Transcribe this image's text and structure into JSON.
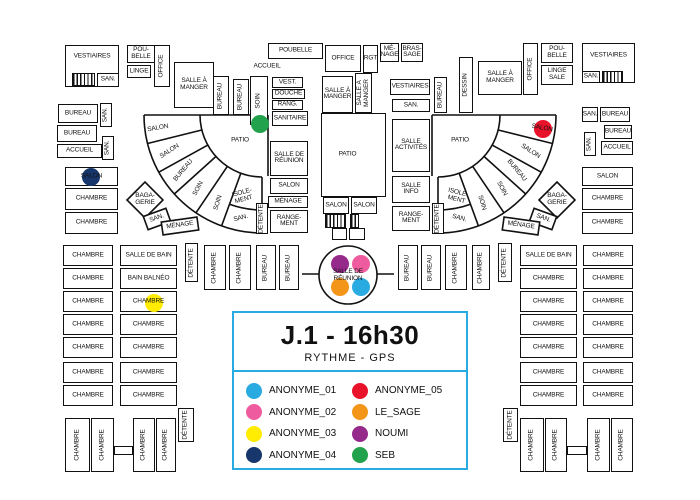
{
  "colors": {
    "wall": "#111111",
    "accent": "#29ABE2",
    "background": "#ffffff"
  },
  "title_card": {
    "title": "J.1 - 16h30",
    "subtitle": "RYTHME - GPS"
  },
  "people": [
    {
      "name": "ANONYME_01",
      "color": "#29ABE2"
    },
    {
      "name": "ANONYME_02",
      "color": "#EE5C9F"
    },
    {
      "name": "ANONYME_03",
      "color": "#FFEC00"
    },
    {
      "name": "ANONYME_04",
      "color": "#17366B"
    },
    {
      "name": "ANONYME_05",
      "color": "#E8132B"
    },
    {
      "name": "LE_SAGE",
      "color": "#F39519"
    },
    {
      "name": "NOUMI",
      "color": "#962A8B"
    },
    {
      "name": "SEB",
      "color": "#23A24D"
    }
  ],
  "markers": [
    {
      "person": "SEB",
      "x": 260,
      "y": 124
    },
    {
      "person": "ANONYME_04",
      "x": 91,
      "y": 177
    },
    {
      "person": "ANONYME_05",
      "x": 543,
      "y": 129
    },
    {
      "person": "ANONYME_03",
      "x": 154,
      "y": 303
    },
    {
      "person": "NOUMI",
      "x": 340,
      "y": 264
    },
    {
      "person": "ANONYME_02",
      "x": 361,
      "y": 264
    },
    {
      "person": "LE_SAGE",
      "x": 340,
      "y": 287
    },
    {
      "person": "ANONYME_01",
      "x": 361,
      "y": 287
    }
  ],
  "floor_plan": {
    "rooms": [
      {
        "t": "VESTIAIRES",
        "x": 65,
        "y": 45,
        "w": 54,
        "h": 42,
        "ly": -9
      },
      {
        "t": "",
        "x": 72,
        "y": 73,
        "w": 23,
        "h": 13,
        "hatch": 1
      },
      {
        "t": "SAN.",
        "x": 97,
        "y": 73,
        "w": 22,
        "h": 14
      },
      {
        "t": "POU-\nBELLE",
        "x": 127,
        "y": 45,
        "w": 28,
        "h": 18
      },
      {
        "t": "LINGE",
        "x": 127,
        "y": 65,
        "w": 24,
        "h": 13
      },
      {
        "t": "OFFICE",
        "x": 154,
        "y": 45,
        "w": 16,
        "h": 42,
        "v": 1
      },
      {
        "t": "SALLE À\nMANGER",
        "x": 174,
        "y": 62,
        "w": 40,
        "h": 46
      },
      {
        "t": "BUREAU",
        "x": 213,
        "y": 76,
        "w": 16,
        "h": 39,
        "v": 1
      },
      {
        "t": "BUREAU",
        "x": 233,
        "y": 79,
        "w": 16,
        "h": 36,
        "v": 1
      },
      {
        "t": "SOIN",
        "x": 250,
        "y": 76,
        "w": 18,
        "h": 49,
        "v": 1
      },
      {
        "t": "BUREAU",
        "x": 58,
        "y": 104,
        "w": 40,
        "h": 19
      },
      {
        "t": "SAN.",
        "x": 100,
        "y": 103,
        "w": 12,
        "h": 24,
        "v": 1
      },
      {
        "t": "BUREAU",
        "x": 57,
        "y": 125,
        "w": 40,
        "h": 17
      },
      {
        "t": "SAN.",
        "x": 102,
        "y": 136,
        "w": 12,
        "h": 24,
        "v": 1
      },
      {
        "t": "ACCUEIL",
        "x": 57,
        "y": 144,
        "w": 45,
        "h": 14
      },
      {
        "t": "SALON",
        "x": 65,
        "y": 167,
        "w": 53,
        "h": 19
      },
      {
        "t": "CHAMBRE",
        "x": 65,
        "y": 188,
        "w": 53,
        "h": 22
      },
      {
        "t": "CHAMBRE",
        "x": 65,
        "y": 212,
        "w": 53,
        "h": 22
      },
      {
        "t": "POUBELLE",
        "x": 268,
        "y": 43,
        "w": 55,
        "h": 16
      },
      {
        "t": "OFFICE",
        "x": 325,
        "y": 45,
        "w": 36,
        "h": 27
      },
      {
        "t": "RGT",
        "x": 363,
        "y": 45,
        "w": 15,
        "h": 28
      },
      {
        "t": "MÉ-\nNAGE",
        "x": 380,
        "y": 43,
        "w": 19,
        "h": 19
      },
      {
        "t": "BRAS-\nSAGE",
        "x": 401,
        "y": 43,
        "w": 22,
        "h": 19
      },
      {
        "t": "VEST.",
        "x": 272,
        "y": 77,
        "w": 31,
        "h": 11
      },
      {
        "t": "DOUCHE",
        "x": 272,
        "y": 89,
        "w": 33,
        "h": 10
      },
      {
        "t": "RANG.",
        "x": 272,
        "y": 100,
        "w": 31,
        "h": 10
      },
      {
        "t": "SANITAIRE",
        "x": 272,
        "y": 111,
        "w": 36,
        "h": 15
      },
      {
        "t": "SALLE À\nMANGER",
        "x": 322,
        "y": 76,
        "w": 31,
        "h": 37
      },
      {
        "t": "SALLE À\nMANGER",
        "x": 355,
        "y": 73,
        "w": 17,
        "h": 40,
        "v": 1
      },
      {
        "t": "VESTIAIRES",
        "x": 390,
        "y": 79,
        "w": 40,
        "h": 16
      },
      {
        "t": "SAN.",
        "x": 392,
        "y": 99,
        "w": 38,
        "h": 13
      },
      {
        "t": "BUREAU",
        "x": 434,
        "y": 77,
        "w": 13,
        "h": 36,
        "v": 1
      },
      {
        "t": "DESSIN",
        "x": 459,
        "y": 57,
        "w": 14,
        "h": 56,
        "v": 1
      },
      {
        "t": "SALLE À\nMANGER",
        "x": 478,
        "y": 61,
        "w": 44,
        "h": 34
      },
      {
        "t": "OFFICE",
        "x": 523,
        "y": 43,
        "w": 15,
        "h": 52,
        "v": 1
      },
      {
        "t": "POU-\nBELLE",
        "x": 541,
        "y": 43,
        "w": 32,
        "h": 20
      },
      {
        "t": "LINGE\nSALE",
        "x": 541,
        "y": 65,
        "w": 32,
        "h": 20
      },
      {
        "t": "VESTIAIRES",
        "x": 582,
        "y": 43,
        "w": 53,
        "h": 40,
        "ly": -7
      },
      {
        "t": "SAN.",
        "x": 582,
        "y": 71,
        "w": 18,
        "h": 12
      },
      {
        "t": "",
        "x": 602,
        "y": 71,
        "w": 21,
        "h": 12,
        "hatch": 1
      },
      {
        "t": "SAN.",
        "x": 582,
        "y": 107,
        "w": 16,
        "h": 15
      },
      {
        "t": "BUREAU",
        "x": 600,
        "y": 107,
        "w": 30,
        "h": 15
      },
      {
        "t": "BUREAU",
        "x": 604,
        "y": 125,
        "w": 28,
        "h": 14
      },
      {
        "t": "SAN.",
        "x": 584,
        "y": 132,
        "w": 12,
        "h": 24,
        "v": 1
      },
      {
        "t": "ACCUEIL",
        "x": 601,
        "y": 141,
        "w": 32,
        "h": 14
      },
      {
        "t": "SALON",
        "x": 582,
        "y": 167,
        "w": 51,
        "h": 19
      },
      {
        "t": "CHAMBRE",
        "x": 582,
        "y": 188,
        "w": 51,
        "h": 22
      },
      {
        "t": "CHAMBRE",
        "x": 582,
        "y": 212,
        "w": 51,
        "h": 22
      },
      {
        "t": "SALLE DE\nRÉUNION",
        "x": 270,
        "y": 141,
        "w": 38,
        "h": 35
      },
      {
        "t": "SALON",
        "x": 270,
        "y": 178,
        "w": 38,
        "h": 16
      },
      {
        "t": "MÉNAGE",
        "x": 268,
        "y": 196,
        "w": 40,
        "h": 12
      },
      {
        "t": "RANGE-\nMENT",
        "x": 270,
        "y": 210,
        "w": 38,
        "h": 23
      },
      {
        "t": "DÉTENTE",
        "x": 256,
        "y": 203,
        "w": 12,
        "h": 31,
        "v": 1
      },
      {
        "t": "SALLE\nACTIVITÉS",
        "x": 392,
        "y": 119,
        "w": 38,
        "h": 53
      },
      {
        "t": "SALLE\nINFO",
        "x": 392,
        "y": 176,
        "w": 38,
        "h": 27
      },
      {
        "t": "RANGE-\nMENT",
        "x": 392,
        "y": 206,
        "w": 38,
        "h": 25
      },
      {
        "t": "DÉTENTE",
        "x": 432,
        "y": 203,
        "w": 12,
        "h": 31,
        "v": 1
      },
      {
        "t": "PATIO",
        "x": 321,
        "y": 113,
        "w": 65,
        "h": 84,
        "lx": -6
      },
      {
        "t": "SALON",
        "x": 323,
        "y": 197,
        "w": 26,
        "h": 17
      },
      {
        "t": "SALON",
        "x": 351,
        "y": 197,
        "w": 26,
        "h": 17
      },
      {
        "t": "",
        "x": 325,
        "y": 214,
        "w": 21,
        "h": 14,
        "hatch": 1
      },
      {
        "t": "",
        "x": 350,
        "y": 214,
        "w": 9,
        "h": 14,
        "hatch": 1
      },
      {
        "t": "",
        "x": 332,
        "y": 228,
        "w": 15,
        "h": 12
      },
      {
        "t": "",
        "x": 349,
        "y": 228,
        "w": 16,
        "h": 12
      },
      {
        "t": "DÉTENTE",
        "x": 185,
        "y": 243,
        "w": 13,
        "h": 39,
        "v": 1
      },
      {
        "t": "CHAMBRE",
        "x": 204,
        "y": 245,
        "w": 22,
        "h": 45,
        "v": 1
      },
      {
        "t": "CHAMBRE",
        "x": 229,
        "y": 245,
        "w": 22,
        "h": 45,
        "v": 1
      },
      {
        "t": "BUREAU",
        "x": 256,
        "y": 245,
        "w": 20,
        "h": 45,
        "v": 1
      },
      {
        "t": "BUREAU",
        "x": 279,
        "y": 245,
        "w": 20,
        "h": 45,
        "v": 1
      },
      {
        "t": "BUREAU",
        "x": 398,
        "y": 245,
        "w": 20,
        "h": 45,
        "v": 1
      },
      {
        "t": "BUREAU",
        "x": 421,
        "y": 245,
        "w": 20,
        "h": 45,
        "v": 1
      },
      {
        "t": "CHAMBRE",
        "x": 445,
        "y": 245,
        "w": 22,
        "h": 45,
        "v": 1
      },
      {
        "t": "CHAMBRE",
        "x": 472,
        "y": 245,
        "w": 18,
        "h": 45,
        "v": 1
      },
      {
        "t": "DÉTENTE",
        "x": 498,
        "y": 243,
        "w": 14,
        "h": 39,
        "v": 1
      },
      {
        "t": "CHAMBRE",
        "x": 63,
        "y": 245,
        "w": 50,
        "h": 21
      },
      {
        "t": "CHAMBRE",
        "x": 63,
        "y": 268,
        "w": 50,
        "h": 21
      },
      {
        "t": "CHAMBRE",
        "x": 63,
        "y": 291,
        "w": 50,
        "h": 21
      },
      {
        "t": "CHAMBRE",
        "x": 63,
        "y": 314,
        "w": 50,
        "h": 21
      },
      {
        "t": "CHAMBRE",
        "x": 63,
        "y": 337,
        "w": 50,
        "h": 21
      },
      {
        "t": "CHAMBRE",
        "x": 63,
        "y": 362,
        "w": 50,
        "h": 21
      },
      {
        "t": "CHAMBRE",
        "x": 63,
        "y": 385,
        "w": 50,
        "h": 21
      },
      {
        "t": "SALLE DE BAIN",
        "x": 120,
        "y": 245,
        "w": 57,
        "h": 21
      },
      {
        "t": "BAIN BALNÉO",
        "x": 120,
        "y": 268,
        "w": 57,
        "h": 21
      },
      {
        "t": "CHAMBRE",
        "x": 120,
        "y": 291,
        "w": 57,
        "h": 21
      },
      {
        "t": "CHAMBRE",
        "x": 120,
        "y": 314,
        "w": 57,
        "h": 21
      },
      {
        "t": "CHAMBRE",
        "x": 120,
        "y": 337,
        "w": 57,
        "h": 21
      },
      {
        "t": "CHAMBRE",
        "x": 120,
        "y": 362,
        "w": 57,
        "h": 21
      },
      {
        "t": "CHAMBRE",
        "x": 120,
        "y": 385,
        "w": 57,
        "h": 21
      },
      {
        "t": "SALLE DE BAIN",
        "x": 520,
        "y": 245,
        "w": 57,
        "h": 21
      },
      {
        "t": "CHAMBRE",
        "x": 520,
        "y": 268,
        "w": 57,
        "h": 21
      },
      {
        "t": "CHAMBRE",
        "x": 520,
        "y": 291,
        "w": 57,
        "h": 21
      },
      {
        "t": "CHAMBRE",
        "x": 520,
        "y": 314,
        "w": 57,
        "h": 21
      },
      {
        "t": "CHAMBRE",
        "x": 520,
        "y": 337,
        "w": 57,
        "h": 21
      },
      {
        "t": "CHAMBRE",
        "x": 520,
        "y": 362,
        "w": 57,
        "h": 21
      },
      {
        "t": "CHAMBRE",
        "x": 520,
        "y": 385,
        "w": 57,
        "h": 21
      },
      {
        "t": "CHAMBRE",
        "x": 583,
        "y": 245,
        "w": 50,
        "h": 21
      },
      {
        "t": "CHAMBRE",
        "x": 583,
        "y": 268,
        "w": 50,
        "h": 21
      },
      {
        "t": "CHAMBRE",
        "x": 583,
        "y": 291,
        "w": 50,
        "h": 21
      },
      {
        "t": "CHAMBRE",
        "x": 583,
        "y": 314,
        "w": 50,
        "h": 21
      },
      {
        "t": "CHAMBRE",
        "x": 583,
        "y": 337,
        "w": 50,
        "h": 21
      },
      {
        "t": "CHAMBRE",
        "x": 583,
        "y": 362,
        "w": 50,
        "h": 21
      },
      {
        "t": "CHAMBRE",
        "x": 583,
        "y": 385,
        "w": 50,
        "h": 21
      },
      {
        "t": "CHAMBRE",
        "x": 65,
        "y": 418,
        "w": 25,
        "h": 54,
        "v": 1
      },
      {
        "t": "CHAMBRE",
        "x": 91,
        "y": 418,
        "w": 23,
        "h": 54,
        "v": 1
      },
      {
        "t": "",
        "x": 114,
        "y": 446,
        "w": 19,
        "h": 9
      },
      {
        "t": "CHAMBRE",
        "x": 133,
        "y": 418,
        "w": 22,
        "h": 54,
        "v": 1
      },
      {
        "t": "CHAMBRE",
        "x": 156,
        "y": 418,
        "w": 20,
        "h": 54,
        "v": 1
      },
      {
        "t": "DÉTENTE",
        "x": 178,
        "y": 408,
        "w": 16,
        "h": 34,
        "v": 1
      },
      {
        "t": "DÉTENTE",
        "x": 503,
        "y": 408,
        "w": 15,
        "h": 34,
        "v": 1
      },
      {
        "t": "CHAMBRE",
        "x": 520,
        "y": 418,
        "w": 24,
        "h": 54,
        "v": 1
      },
      {
        "t": "CHAMBRE",
        "x": 545,
        "y": 418,
        "w": 22,
        "h": 54,
        "v": 1
      },
      {
        "t": "",
        "x": 567,
        "y": 446,
        "w": 20,
        "h": 9
      },
      {
        "t": "CHAMBRE",
        "x": 587,
        "y": 418,
        "w": 23,
        "h": 54,
        "v": 1
      },
      {
        "t": "CHAMBRE",
        "x": 611,
        "y": 418,
        "w": 22,
        "h": 54,
        "v": 1
      }
    ],
    "free_labels": [
      {
        "t": "ACCUEIL",
        "x": 267,
        "y": 67,
        "r": 0
      },
      {
        "t": "PATIO",
        "x": 240,
        "y": 141,
        "r": 0
      },
      {
        "t": "PATIO",
        "x": 460,
        "y": 141,
        "r": 0
      },
      {
        "t": "SALON",
        "x": 158,
        "y": 129,
        "r": -10
      },
      {
        "t": "SALON",
        "x": 170,
        "y": 152,
        "r": -33
      },
      {
        "t": "BUREAU",
        "x": 184,
        "y": 171,
        "r": -50
      },
      {
        "t": "SOIN",
        "x": 199,
        "y": 189,
        "r": -62
      },
      {
        "t": "SOIN",
        "x": 219,
        "y": 203,
        "r": -73
      },
      {
        "t": "ISOLE-\nMENT",
        "x": 243,
        "y": 197,
        "r": -15
      },
      {
        "t": "SAN.",
        "x": 241,
        "y": 219,
        "r": -15
      },
      {
        "t": "BAGA-\nGERIE",
        "x": 145,
        "y": 200,
        "r": 0
      },
      {
        "t": "SAN.",
        "x": 157,
        "y": 219,
        "r": -20
      },
      {
        "t": "MÉNAGE",
        "x": 180,
        "y": 226,
        "r": -8
      },
      {
        "t": "SALON",
        "x": 542,
        "y": 129,
        "r": 10
      },
      {
        "t": "SALON",
        "x": 530,
        "y": 152,
        "r": 33
      },
      {
        "t": "BUREAU",
        "x": 516,
        "y": 171,
        "r": 50
      },
      {
        "t": "SOIN",
        "x": 501,
        "y": 189,
        "r": 62
      },
      {
        "t": "SOIN",
        "x": 481,
        "y": 203,
        "r": 73
      },
      {
        "t": "ISOLE-\nMENT",
        "x": 457,
        "y": 197,
        "r": 15
      },
      {
        "t": "SAN.",
        "x": 459,
        "y": 219,
        "r": 15
      },
      {
        "t": "BAGA-\nGERIE",
        "x": 557,
        "y": 200,
        "r": 0
      },
      {
        "t": "SAN.",
        "x": 543,
        "y": 219,
        "r": 20
      },
      {
        "t": "MÉNAGE",
        "x": 521,
        "y": 226,
        "r": 8
      },
      {
        "t": "SALLE DE\nRÉUNION",
        "x": 348,
        "y": 276,
        "r": 0
      }
    ]
  }
}
